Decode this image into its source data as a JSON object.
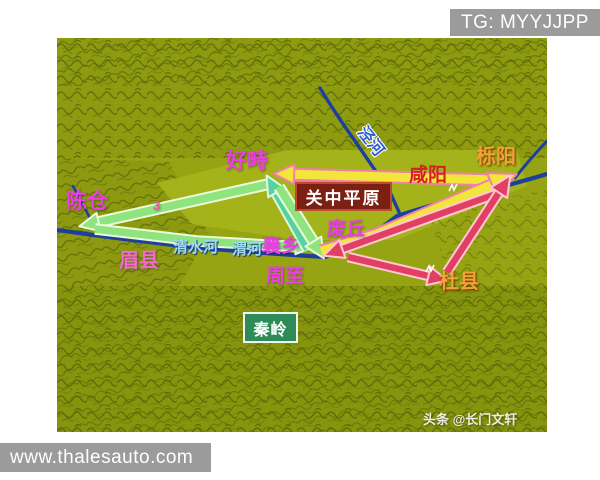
{
  "banners": {
    "top_right": "TG: MYYJJPP",
    "bottom_left": "www.thalesauto.com"
  },
  "map": {
    "credit": "头条 @长门文轩",
    "labels": {
      "chencang": "陈仓",
      "haozhi": "好畤",
      "liyang": "栎阳",
      "xianyang": "咸阳",
      "guanzhong_plain": "关中平原",
      "feiqiu": "废丘",
      "xiangxiang": "襄乡",
      "zhouzhi": "周至",
      "meixian": "眉县",
      "duxian": "杜县",
      "qinling": "秦岭",
      "qingshui_river": "清水河",
      "wei_river": "渭河",
      "jing_river": "泾河",
      "route_number_3": "3"
    },
    "colors": {
      "terrain_base": "#96a414",
      "plain": "#a6b41c",
      "river": "#1d3f9e",
      "route_green": "#8fe47f",
      "route_teal": "#55d29e",
      "route_yellow": "#f3e53a",
      "route_yellow_edge": "#f07fae",
      "route_red": "#e23f64",
      "label_magenta": "#e93fe3",
      "label_orange": "#f2a238",
      "label_red": "#d42222",
      "label_cyan": "#9fdcf2",
      "banner_gray": "#9b9b9b"
    },
    "routes": [
      {
        "name": "green-haozhi-to-chencang",
        "from": "好畤",
        "to": "陈仓",
        "fill": "#8fe47f",
        "edge": "#eafcd9",
        "width": 8,
        "head": "end",
        "head_size": 1.1,
        "points": [
          [
            212,
            146
          ],
          [
            33,
            186
          ]
        ]
      },
      {
        "name": "green-chencang-to-xiangxiang",
        "from": "陈仓",
        "to": "襄乡",
        "fill": "#8fe47f",
        "edge": "#eafcd9",
        "width": 7.5,
        "head": "end",
        "head_size": 0.9,
        "points": [
          [
            38,
            191
          ],
          [
            140,
            203
          ],
          [
            246,
            209
          ]
        ]
      },
      {
        "name": "teal-xiangxiang-to-haozhi",
        "from": "襄乡",
        "to": "好畤",
        "fill": "#55d29e",
        "edge": "#dcf7e4",
        "width": 8,
        "head": "end",
        "head_size": 1.1,
        "points": [
          [
            251,
            211
          ],
          [
            215,
            147
          ]
        ]
      },
      {
        "name": "green-haozhi-to-xiangxiang",
        "from": "好畤",
        "to": "襄乡",
        "fill": "#8fe47f",
        "edge": "#eafcd9",
        "width": 8,
        "head": "end",
        "head_size": 1.1,
        "points": [
          [
            222,
            149
          ],
          [
            261,
            211
          ]
        ]
      },
      {
        "name": "yellow-liyang-to-haozhi",
        "from": "栎阳",
        "to": "好畤",
        "fill": "#f3e53a",
        "edge": "#f07fae",
        "width": 9,
        "head": "end",
        "head_size": 1.15,
        "points": [
          [
            438,
            142
          ],
          [
            228,
            136
          ]
        ]
      },
      {
        "name": "yellow-xiangxiang-to-liyang",
        "from": "襄乡",
        "to": "栎阳",
        "fill": "#f3e53a",
        "edge": "#f07fae",
        "width": 9,
        "head": "end",
        "head_size": 1.5,
        "points": [
          [
            264,
            213
          ],
          [
            320,
            196
          ],
          [
            446,
            142
          ]
        ]
      },
      {
        "name": "red-liyang-to-feiqiu",
        "from": "栎阳",
        "to": "废丘",
        "fill": "#e23f64",
        "edge": "#ffc9d2",
        "width": 6.5,
        "head": "end",
        "head_size": 1.1,
        "points": [
          [
            450,
            152
          ],
          [
            277,
            214
          ]
        ]
      },
      {
        "name": "red-feiqiu-to-duxian",
        "from": "废丘",
        "to": "杜县",
        "fill": "#e23f64",
        "edge": "#ffc9d2",
        "width": 6.5,
        "head": "end",
        "head_size": 1.1,
        "points": [
          [
            291,
            219
          ],
          [
            380,
            240
          ]
        ]
      },
      {
        "name": "red-duxian-to-liyang",
        "from": "杜县",
        "to": "栎阳",
        "fill": "#e23f64",
        "edge": "#ffc9d2",
        "width": 6.5,
        "head": "end",
        "head_size": 1.15,
        "points": [
          [
            390,
            234
          ],
          [
            447,
            147
          ]
        ]
      }
    ]
  }
}
